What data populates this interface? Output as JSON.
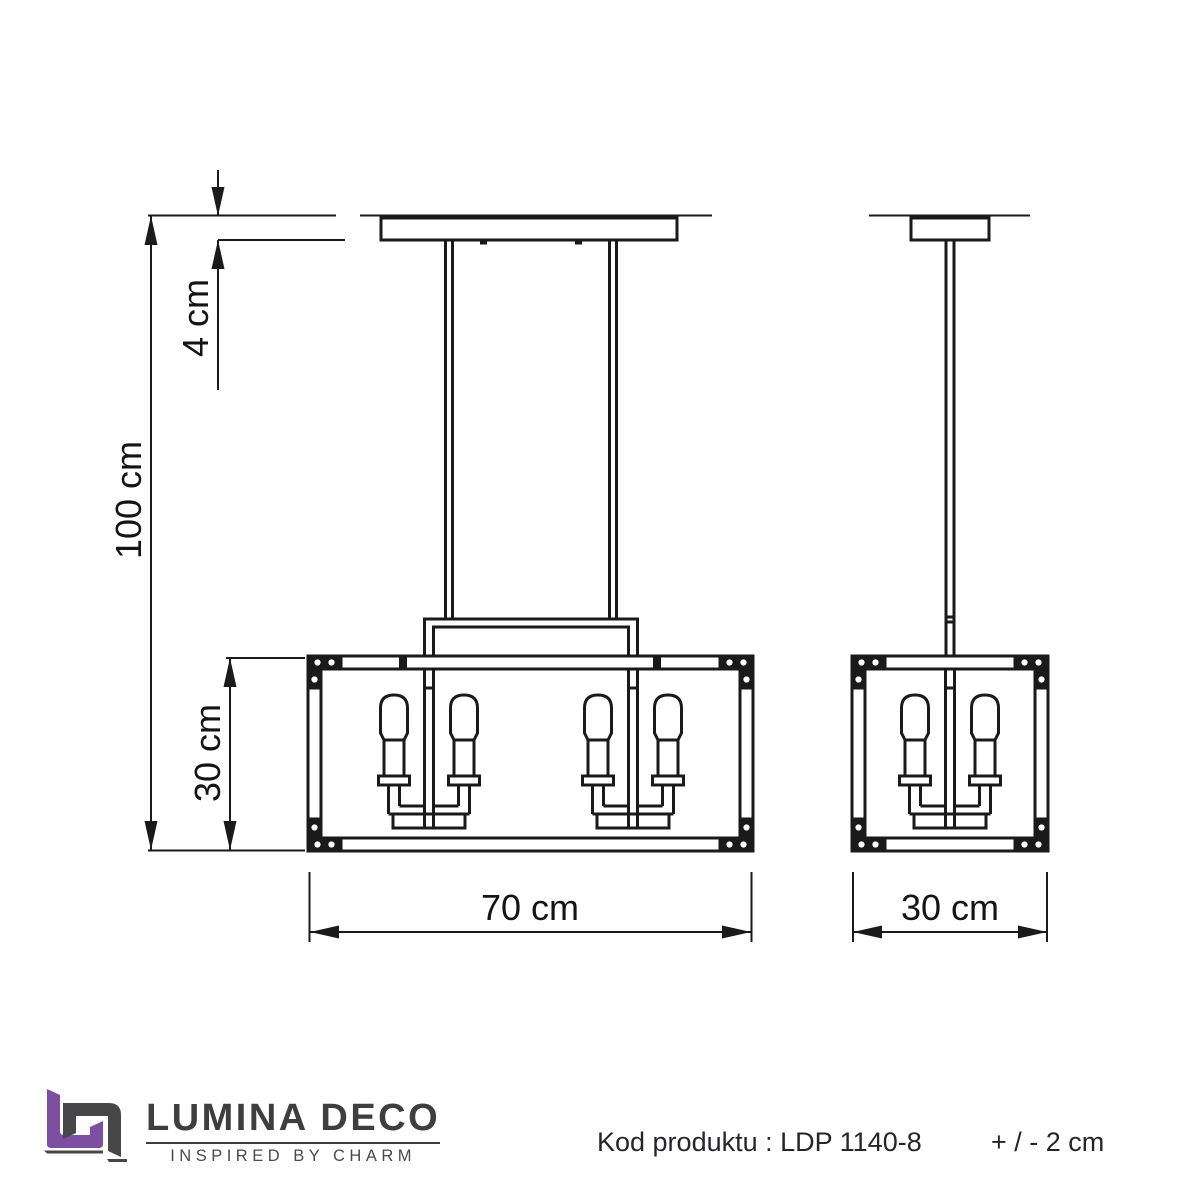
{
  "drawing": {
    "stroke_color": "#1a1a1a",
    "dimensions": {
      "overall_height": "100 cm",
      "canopy_height": "4 cm",
      "shade_height": "30 cm",
      "shade_width": "70 cm",
      "shade_depth": "30 cm"
    }
  },
  "footer": {
    "brand": "LUMINA DECO",
    "tagline": "INSPIRED BY CHARM",
    "product_code": "Kod produktu : LDP 1140-8",
    "tolerance": "+ / - 2 cm",
    "logo_purple": "#7c4fa0",
    "logo_gray": "#47474a"
  }
}
